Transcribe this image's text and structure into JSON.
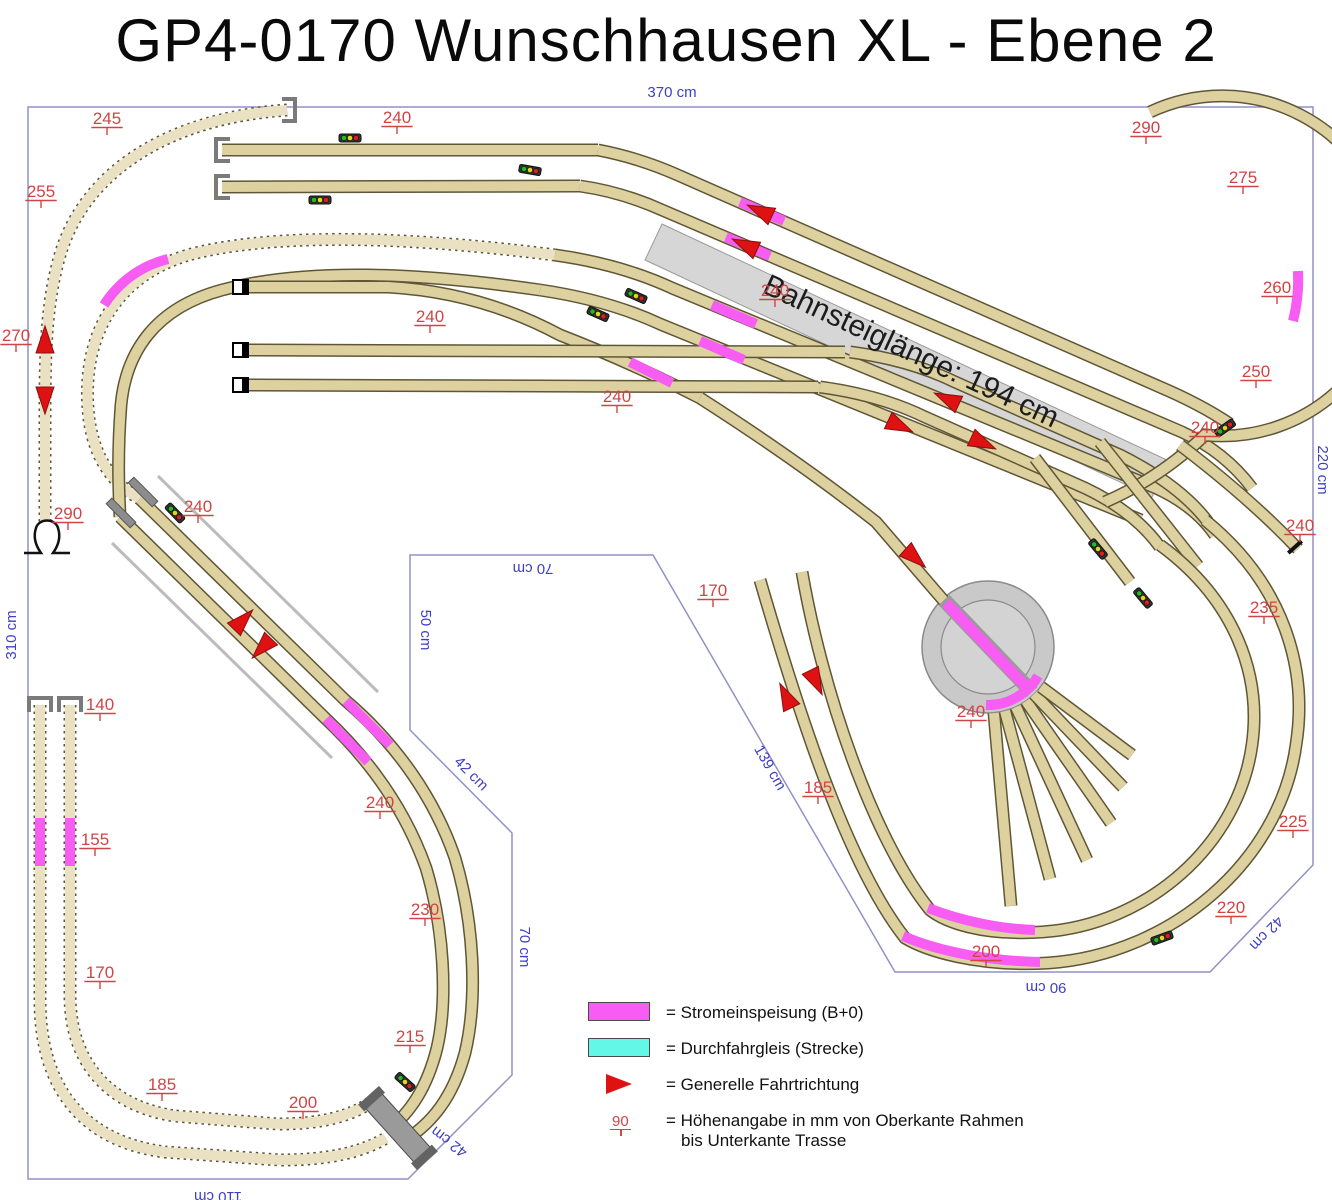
{
  "header": {
    "title": "GP4-0170 Wunschhausen XL - Ebene 2"
  },
  "platform": {
    "label": "Bahnsteiglänge: 194 cm"
  },
  "legend": {
    "items": [
      {
        "type": "power-feed",
        "label": "= Stromeinspeisung (B+0)"
      },
      {
        "type": "through-track",
        "label": "= Durchfahrgleis (Strecke)"
      },
      {
        "type": "direction",
        "label": "= Generelle Fahrtrichtung"
      },
      {
        "type": "height-marker",
        "symbol": "90",
        "label": "= Höhenangabe in mm von Oberkante Rahmen",
        "label2": "bis Unterkante Trasse"
      }
    ]
  },
  "colors": {
    "track_fill": "#ddd1a0",
    "track_outline": "#5f5636",
    "hidden_track_fill": "#eae1c2",
    "power_feed": "#f75df2",
    "through_track": "#63f7e8",
    "direction_arrow": "#de1212",
    "height_label": "#d14444",
    "dimension_label": "#3f3fc4",
    "platform": "#d6d6d6",
    "turntable": "#c9c9c9",
    "boundary": "#9191c8"
  },
  "dimension_labels": [
    {
      "t": "370 cm",
      "x": 672,
      "y": 97,
      "r": 0
    },
    {
      "t": "220 cm",
      "x": 1318,
      "y": 470,
      "r": 90
    },
    {
      "t": "310 cm",
      "x": 16,
      "y": 635,
      "r": -90
    },
    {
      "t": "110 cm",
      "x": 218,
      "y": 1192,
      "r": 180
    },
    {
      "t": "90 cm",
      "x": 1046,
      "y": 983,
      "r": 180
    },
    {
      "t": "70 cm",
      "x": 533,
      "y": 564,
      "r": 180
    },
    {
      "t": "50 cm",
      "x": 421,
      "y": 630,
      "r": 90
    },
    {
      "t": "42 cm",
      "x": 468,
      "y": 777,
      "r": 45
    },
    {
      "t": "70 cm",
      "x": 520,
      "y": 947,
      "r": 90
    },
    {
      "t": "42 cm",
      "x": 452,
      "y": 1138,
      "r": 217
    },
    {
      "t": "42 cm",
      "x": 1263,
      "y": 930,
      "r": 134
    },
    {
      "t": "139 cm",
      "x": 766,
      "y": 770,
      "r": 60
    }
  ],
  "height_markers": [
    {
      "t": "245",
      "x": 107,
      "y": 124
    },
    {
      "t": "240",
      "x": 397,
      "y": 123
    },
    {
      "t": "290",
      "x": 1146,
      "y": 133
    },
    {
      "t": "275",
      "x": 1243,
      "y": 183
    },
    {
      "t": "255",
      "x": 41,
      "y": 197
    },
    {
      "t": "260",
      "x": 1277,
      "y": 293
    },
    {
      "t": "240",
      "x": 430,
      "y": 322
    },
    {
      "t": "270",
      "x": 16,
      "y": 341
    },
    {
      "t": "240",
      "x": 775,
      "y": 296
    },
    {
      "t": "250",
      "x": 1256,
      "y": 377
    },
    {
      "t": "240",
      "x": 617,
      "y": 402
    },
    {
      "t": "240",
      "x": 1205,
      "y": 433
    },
    {
      "t": "290",
      "x": 68,
      "y": 519
    },
    {
      "t": "240",
      "x": 198,
      "y": 512
    },
    {
      "t": "240",
      "x": 1300,
      "y": 531
    },
    {
      "t": "170",
      "x": 713,
      "y": 596
    },
    {
      "t": "235",
      "x": 1264,
      "y": 613
    },
    {
      "t": "140",
      "x": 100,
      "y": 710
    },
    {
      "t": "240",
      "x": 971,
      "y": 717
    },
    {
      "t": "185",
      "x": 818,
      "y": 793
    },
    {
      "t": "240",
      "x": 380,
      "y": 808
    },
    {
      "t": "155",
      "x": 95,
      "y": 845
    },
    {
      "t": "225",
      "x": 1293,
      "y": 827
    },
    {
      "t": "230",
      "x": 425,
      "y": 915
    },
    {
      "t": "220",
      "x": 1231,
      "y": 913
    },
    {
      "t": "170",
      "x": 100,
      "y": 978
    },
    {
      "t": "200",
      "x": 986,
      "y": 957
    },
    {
      "t": "215",
      "x": 410,
      "y": 1042
    },
    {
      "t": "185",
      "x": 162,
      "y": 1090
    },
    {
      "t": "200",
      "x": 303,
      "y": 1108
    }
  ],
  "arrows": [
    {
      "x": 45,
      "y": 340,
      "r": -90
    },
    {
      "x": 45,
      "y": 400,
      "r": 90
    },
    {
      "x": 760,
      "y": 211,
      "r": 205
    },
    {
      "x": 745,
      "y": 245,
      "r": 205
    },
    {
      "x": 947,
      "y": 399,
      "r": 205
    },
    {
      "x": 900,
      "y": 426,
      "r": 25
    },
    {
      "x": 983,
      "y": 443,
      "r": 25
    },
    {
      "x": 243,
      "y": 620,
      "r": -46
    },
    {
      "x": 262,
      "y": 648,
      "r": 134
    },
    {
      "x": 786,
      "y": 696,
      "r": 244
    },
    {
      "x": 816,
      "y": 682,
      "r": 64
    },
    {
      "x": 915,
      "y": 558,
      "r": 42
    }
  ],
  "signals": [
    {
      "x": 350,
      "y": 138,
      "r": 0
    },
    {
      "x": 320,
      "y": 200,
      "r": 0
    },
    {
      "x": 530,
      "y": 170,
      "r": 10
    },
    {
      "x": 598,
      "y": 314,
      "r": 24
    },
    {
      "x": 636,
      "y": 296,
      "r": 24
    },
    {
      "x": 175,
      "y": 513,
      "r": 46
    },
    {
      "x": 1225,
      "y": 428,
      "r": -35
    },
    {
      "x": 1098,
      "y": 549,
      "r": 50
    },
    {
      "x": 1143,
      "y": 598,
      "r": 50
    },
    {
      "x": 1162,
      "y": 938,
      "r": -20
    },
    {
      "x": 405,
      "y": 1082,
      "r": 42
    }
  ]
}
